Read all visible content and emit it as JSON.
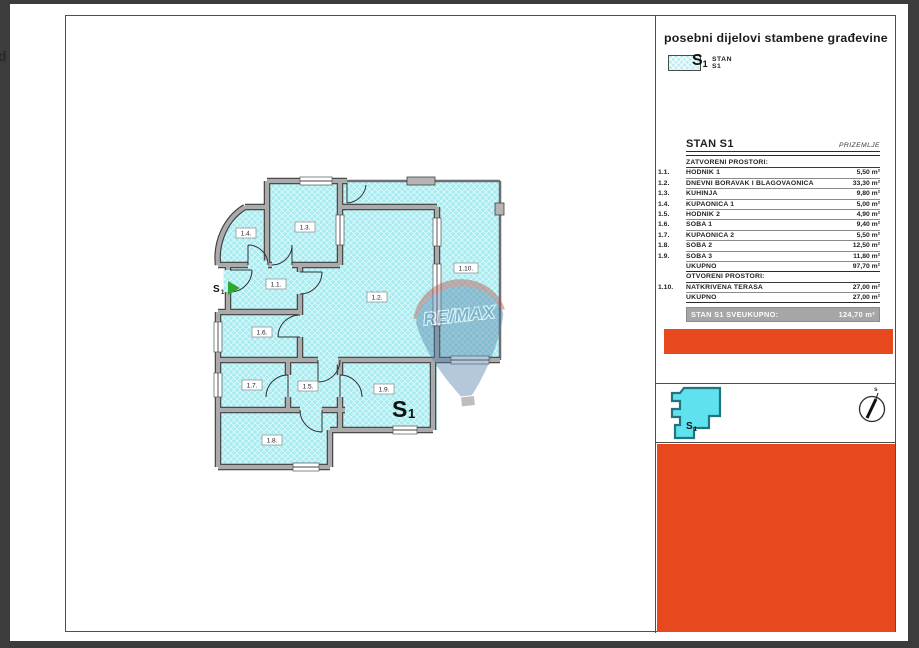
{
  "viewer": {
    "edge_fragment": "d"
  },
  "sheet": {
    "title": "posebni dijelovi stambene građevine",
    "legend": {
      "symbol": "S",
      "symbol_sub": "1",
      "name": "STAN S1"
    },
    "table": {
      "title": "STAN S1",
      "floor": "PRIZEMLJE",
      "closed_section": "ZATVORENI PROSTORI:",
      "rows_closed": [
        {
          "num": "1.1.",
          "name": "HODNIK 1",
          "area": "5,50 m²"
        },
        {
          "num": "1.2.",
          "name": "DNEVNI BORAVAK I BLAGOVAONICA",
          "area": "33,30 m²"
        },
        {
          "num": "1.3.",
          "name": "KUHINJA",
          "area": "9,80 m²"
        },
        {
          "num": "1.4.",
          "name": "KUPAONICA 1",
          "area": "5,00 m²"
        },
        {
          "num": "1.5.",
          "name": "HODNIK 2",
          "area": "4,90 m²"
        },
        {
          "num": "1.6.",
          "name": "SOBA 1",
          "area": "9,40 m²"
        },
        {
          "num": "1.7.",
          "name": "KUPAONICA 2",
          "area": "5,50 m²"
        },
        {
          "num": "1.8.",
          "name": "SOBA 2",
          "area": "12,50 m²"
        },
        {
          "num": "1.9.",
          "name": "SOBA 3",
          "area": "11,80 m²"
        }
      ],
      "total_closed": {
        "label": "UKUPNO",
        "area": "97,70 m²"
      },
      "open_section": "OTVORENI PROSTORI:",
      "rows_open": [
        {
          "num": "1.10.",
          "name": "NATKRIVENA TERASA",
          "area": "27,00 m²"
        }
      ],
      "total_open": {
        "label": "UKUPNO",
        "area": "27,00 m²"
      },
      "grand_total": {
        "label": "STAN S1 SVEUKUPNO:",
        "area": "124,70 m²"
      }
    },
    "key_plan": {
      "symbol": "S",
      "symbol_sub": "1"
    },
    "compass": {
      "north_label": "s"
    },
    "colors": {
      "accent_orange": "#E8481E",
      "room_cyan": "#A7ECF1",
      "total_bar_gray": "#A6A6A6",
      "arrow_green": "#2FA832"
    }
  },
  "plan": {
    "rooms": [
      {
        "label": "1.1."
      },
      {
        "label": "1.2."
      },
      {
        "label": "1.3."
      },
      {
        "label": "1.4."
      },
      {
        "label": "1.5."
      },
      {
        "label": "1.6."
      },
      {
        "label": "1.7."
      },
      {
        "label": "1.8."
      },
      {
        "label": "1.9."
      },
      {
        "label": "1.10."
      }
    ],
    "unit": {
      "symbol": "S",
      "symbol_sub": "1"
    },
    "entrance": {
      "symbol": "S",
      "symbol_sub": "1"
    },
    "watermark": "RE/MAX"
  }
}
